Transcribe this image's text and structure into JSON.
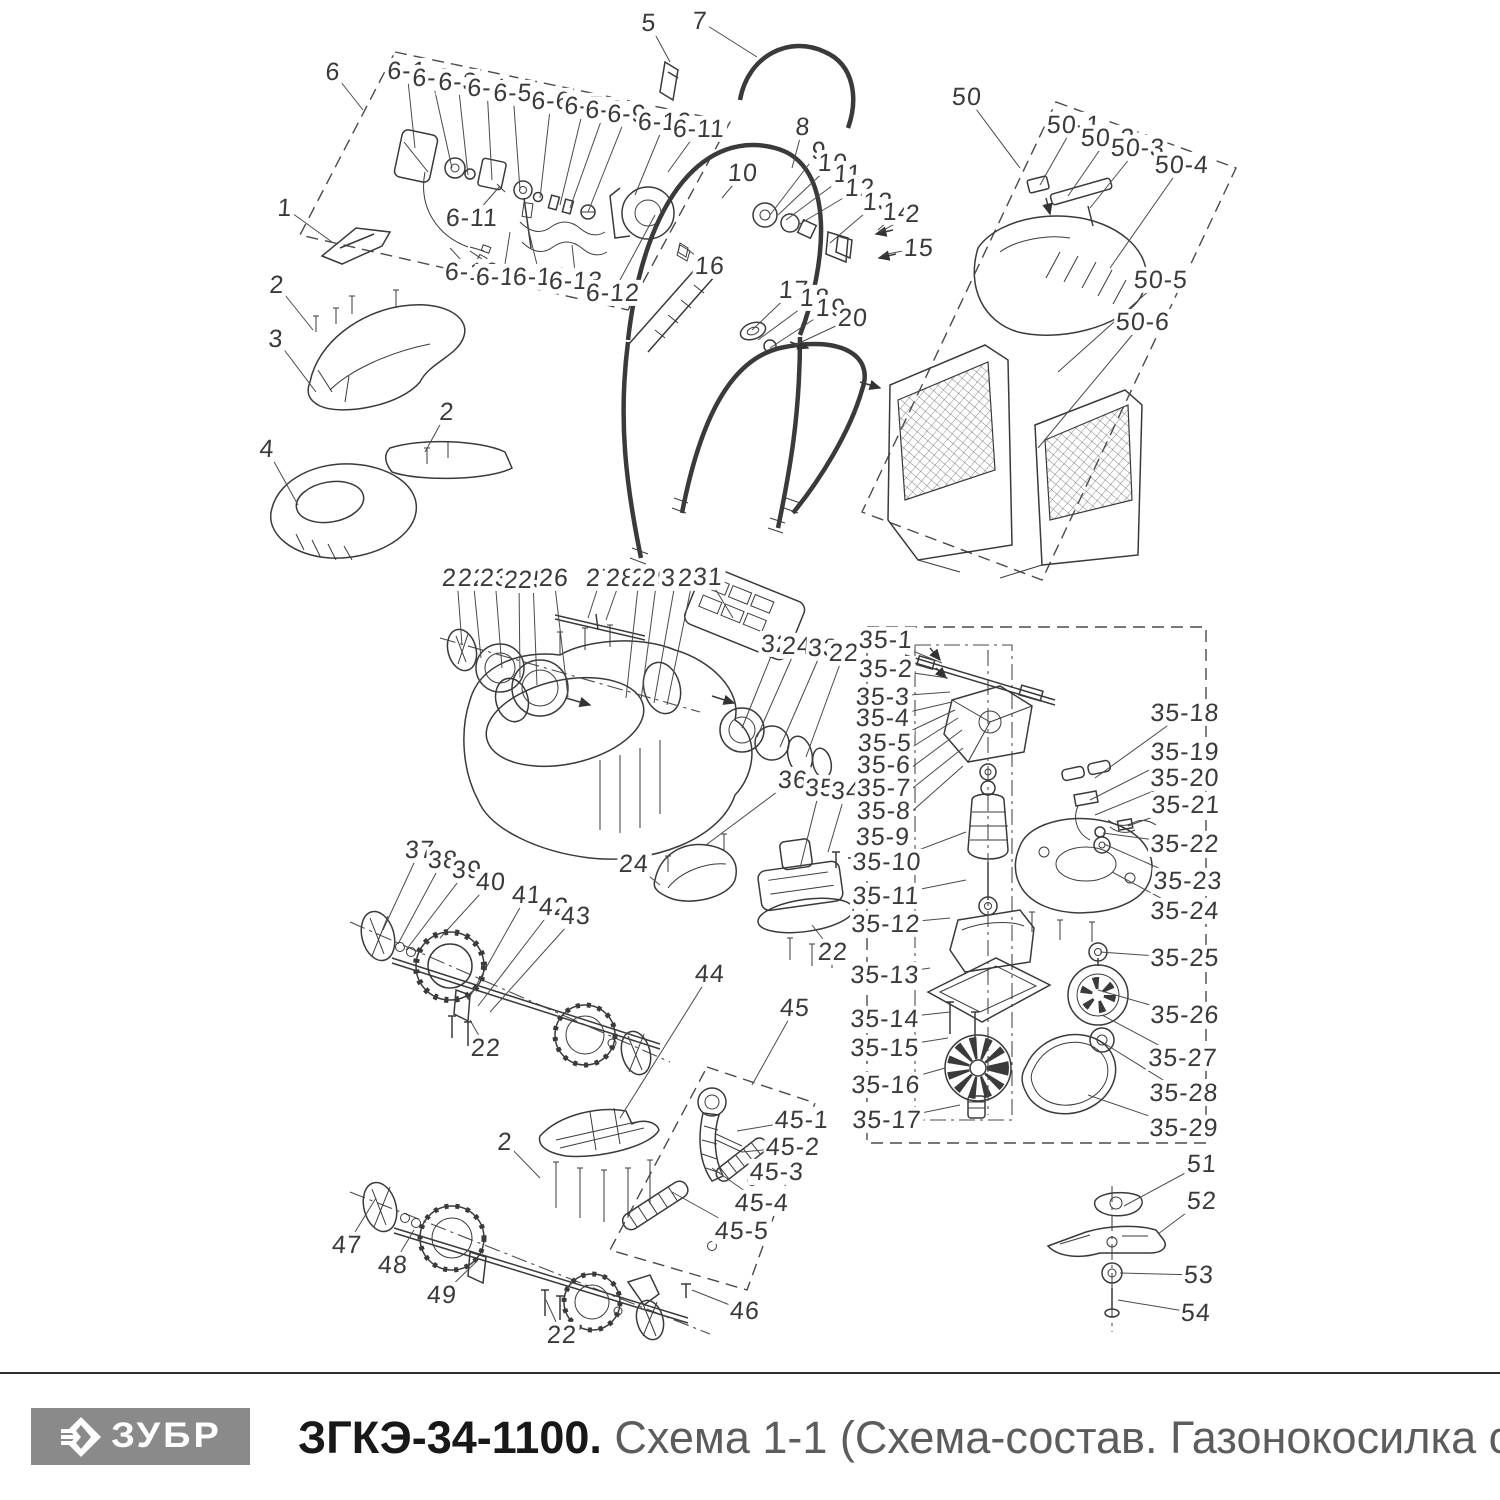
{
  "footer": {
    "brand": "ЗУБР",
    "title_bold": "ЗГКЭ-34-1100.",
    "title_rest": " Схема 1-1 (Схема-состав. Газонокосилка сетевая)"
  },
  "colors": {
    "line": "#3a3a3a",
    "label": "#3a3a3a",
    "logo_bg": "#8a8a8a",
    "logo_fg": "#ffffff",
    "title_black": "#181818",
    "title_gray": "#5c5c5c"
  },
  "labels": [
    {
      "t": "6",
      "x": 333,
      "y": 72,
      "lx": 363,
      "ly": 110
    },
    {
      "t": "6-1",
      "x": 407,
      "y": 71,
      "lx": 415,
      "ly": 148
    },
    {
      "t": "6-2",
      "x": 432,
      "y": 78,
      "lx": 452,
      "ly": 168
    },
    {
      "t": "6-3",
      "x": 458,
      "y": 82,
      "lx": 468,
      "ly": 175
    },
    {
      "t": "6-4",
      "x": 487,
      "y": 88,
      "lx": 492,
      "ly": 180
    },
    {
      "t": "6-5",
      "x": 513,
      "y": 93,
      "lx": 520,
      "ly": 190
    },
    {
      "t": "6-6",
      "x": 551,
      "y": 101,
      "lx": 540,
      "ly": 198
    },
    {
      "t": "6-7",
      "x": 584,
      "y": 106,
      "lx": 560,
      "ly": 205
    },
    {
      "t": "6-8",
      "x": 605,
      "y": 110,
      "lx": 570,
      "ly": 208
    },
    {
      "t": "6-9",
      "x": 627,
      "y": 114,
      "lx": 588,
      "ly": 212
    },
    {
      "t": "6-10",
      "x": 665,
      "y": 122,
      "lx": 635,
      "ly": 195
    },
    {
      "t": "6-11",
      "x": 699,
      "y": 129,
      "lx": 668,
      "ly": 172
    },
    {
      "t": "6-11",
      "x": 472,
      "y": 218,
      "lx": 500,
      "ly": 186
    },
    {
      "t": "6-16",
      "x": 472,
      "y": 272,
      "lx": 450,
      "ly": 248
    },
    {
      "t": "6-15",
      "x": 503,
      "y": 277,
      "lx": 510,
      "ly": 232
    },
    {
      "t": "6-14",
      "x": 540,
      "y": 277,
      "lx": 528,
      "ly": 228
    },
    {
      "t": "6-13",
      "x": 576,
      "y": 281,
      "lx": 572,
      "ly": 245
    },
    {
      "t": "6-12",
      "x": 613,
      "y": 293,
      "lx": 655,
      "ly": 215
    },
    {
      "t": "16",
      "x": 710,
      "y": 266,
      "lx": 688,
      "ly": 250
    },
    {
      "t": "5",
      "x": 649,
      "y": 23,
      "lx": 670,
      "ly": 62
    },
    {
      "t": "7",
      "x": 700,
      "y": 21,
      "lx": 757,
      "ly": 57
    },
    {
      "t": "8",
      "x": 803,
      "y": 127,
      "lx": 792,
      "ly": 168
    },
    {
      "t": "9",
      "x": 819,
      "y": 151,
      "lx": 770,
      "ly": 215
    },
    {
      "t": "10",
      "x": 833,
      "y": 163,
      "lx": 778,
      "ly": 215
    },
    {
      "t": "10",
      "x": 743,
      "y": 173,
      "lx": 722,
      "ly": 198
    },
    {
      "t": "11",
      "x": 848,
      "y": 174,
      "lx": 786,
      "ly": 220
    },
    {
      "t": "12",
      "x": 860,
      "y": 188,
      "lx": 798,
      "ly": 225
    },
    {
      "t": "13",
      "x": 878,
      "y": 202,
      "lx": 830,
      "ly": 243
    },
    {
      "t": "14",
      "x": 898,
      "y": 212,
      "lx": 878,
      "ly": 230
    },
    {
      "t": "2",
      "x": 913,
      "y": 214,
      "lx": 880,
      "ly": 232
    },
    {
      "t": "15",
      "x": 919,
      "y": 248,
      "lx": 882,
      "ly": 255
    },
    {
      "t": "17",
      "x": 794,
      "y": 290,
      "lx": 752,
      "ly": 330
    },
    {
      "t": "18",
      "x": 815,
      "y": 298,
      "lx": 758,
      "ly": 340
    },
    {
      "t": "19",
      "x": 831,
      "y": 308,
      "lx": 770,
      "ly": 348
    },
    {
      "t": "20",
      "x": 853,
      "y": 318,
      "lx": 795,
      "ly": 345
    },
    {
      "t": "50",
      "x": 967,
      "y": 97,
      "lx": 1020,
      "ly": 168
    },
    {
      "t": "50-1",
      "x": 1074,
      "y": 125,
      "lx": 1040,
      "ly": 185
    },
    {
      "t": "50-2",
      "x": 1108,
      "y": 138,
      "lx": 1068,
      "ly": 196
    },
    {
      "t": "50-3",
      "x": 1138,
      "y": 148,
      "lx": 1090,
      "ly": 208
    },
    {
      "t": "50-4",
      "x": 1182,
      "y": 165,
      "lx": 1110,
      "ly": 268
    },
    {
      "t": "50-5",
      "x": 1161,
      "y": 280,
      "lx": 1058,
      "ly": 372
    },
    {
      "t": "50-6",
      "x": 1143,
      "y": 322,
      "lx": 1038,
      "ly": 448
    },
    {
      "t": "1",
      "x": 285,
      "y": 208,
      "lx": 332,
      "ly": 242
    },
    {
      "t": "2",
      "x": 277,
      "y": 285,
      "lx": 313,
      "ly": 330
    },
    {
      "t": "3",
      "x": 276,
      "y": 339,
      "lx": 316,
      "ly": 392
    },
    {
      "t": "2",
      "x": 447,
      "y": 412,
      "lx": 425,
      "ly": 452
    },
    {
      "t": "4",
      "x": 267,
      "y": 449,
      "lx": 298,
      "ly": 505
    },
    {
      "t": "21",
      "x": 457,
      "y": 578,
      "lx": 462,
      "ly": 645
    },
    {
      "t": "22",
      "x": 473,
      "y": 578,
      "lx": 481,
      "ly": 658
    },
    {
      "t": "23",
      "x": 495,
      "y": 578,
      "lx": 502,
      "ly": 668
    },
    {
      "t": "24",
      "x": 519,
      "y": 580,
      "lx": 520,
      "ly": 678
    },
    {
      "t": "25",
      "x": 533,
      "y": 580,
      "lx": 537,
      "ly": 685
    },
    {
      "t": "26",
      "x": 554,
      "y": 578,
      "lx": 568,
      "ly": 697
    },
    {
      "t": "27",
      "x": 601,
      "y": 578,
      "lx": 588,
      "ly": 618
    },
    {
      "t": "28",
      "x": 621,
      "y": 578,
      "lx": 606,
      "ly": 620
    },
    {
      "t": "2",
      "x": 639,
      "y": 578,
      "lx": 626,
      "ly": 698
    },
    {
      "t": "29",
      "x": 657,
      "y": 578,
      "lx": 641,
      "ly": 700
    },
    {
      "t": "30",
      "x": 676,
      "y": 578,
      "lx": 654,
      "ly": 703
    },
    {
      "t": "24",
      "x": 693,
      "y": 578,
      "lx": 667,
      "ly": 705
    },
    {
      "t": "31",
      "x": 708,
      "y": 577,
      "lx": 733,
      "ly": 618
    },
    {
      "t": "32",
      "x": 776,
      "y": 644,
      "lx": 742,
      "ly": 728
    },
    {
      "t": "24",
      "x": 797,
      "y": 646,
      "lx": 757,
      "ly": 737
    },
    {
      "t": "33",
      "x": 823,
      "y": 648,
      "lx": 780,
      "ly": 747
    },
    {
      "t": "22",
      "x": 844,
      "y": 653,
      "lx": 806,
      "ly": 757
    },
    {
      "t": "36",
      "x": 793,
      "y": 780,
      "lx": 706,
      "ly": 845
    },
    {
      "t": "35",
      "x": 820,
      "y": 788,
      "lx": 800,
      "ly": 868
    },
    {
      "t": "34",
      "x": 846,
      "y": 791,
      "lx": 828,
      "ly": 852
    },
    {
      "t": "24",
      "x": 634,
      "y": 864,
      "lx": 660,
      "ly": 885
    },
    {
      "t": "22",
      "x": 833,
      "y": 952,
      "lx": 812,
      "ly": 925
    },
    {
      "t": "35-1",
      "x": 886,
      "y": 640,
      "lx": 942,
      "ly": 663
    },
    {
      "t": "35-2",
      "x": 886,
      "y": 669,
      "lx": 948,
      "ly": 678
    },
    {
      "t": "35-3",
      "x": 883,
      "y": 697,
      "lx": 950,
      "ly": 692
    },
    {
      "t": "35-4",
      "x": 883,
      "y": 718,
      "lx": 952,
      "ly": 702
    },
    {
      "t": "35-5",
      "x": 885,
      "y": 743,
      "lx": 955,
      "ly": 710
    },
    {
      "t": "35-6",
      "x": 884,
      "y": 765,
      "lx": 958,
      "ly": 718
    },
    {
      "t": "35-7",
      "x": 884,
      "y": 788,
      "lx": 962,
      "ly": 730
    },
    {
      "t": "35-8",
      "x": 884,
      "y": 811,
      "lx": 963,
      "ly": 748
    },
    {
      "t": "35-9",
      "x": 883,
      "y": 837,
      "lx": 963,
      "ly": 766
    },
    {
      "t": "35-10",
      "x": 887,
      "y": 862,
      "lx": 966,
      "ly": 832
    },
    {
      "t": "35-11",
      "x": 886,
      "y": 896,
      "lx": 966,
      "ly": 880
    },
    {
      "t": "35-12",
      "x": 886,
      "y": 924,
      "lx": 950,
      "ly": 918
    },
    {
      "t": "35-13",
      "x": 885,
      "y": 975,
      "lx": 930,
      "ly": 968
    },
    {
      "t": "35-14",
      "x": 885,
      "y": 1019,
      "lx": 950,
      "ly": 1012
    },
    {
      "t": "35-15",
      "x": 885,
      "y": 1048,
      "lx": 948,
      "ly": 1038
    },
    {
      "t": "35-16",
      "x": 886,
      "y": 1085,
      "lx": 945,
      "ly": 1068
    },
    {
      "t": "35-17",
      "x": 887,
      "y": 1120,
      "lx": 960,
      "ly": 1105
    },
    {
      "t": "35-18",
      "x": 1185,
      "y": 713,
      "lx": 1095,
      "ly": 778
    },
    {
      "t": "35-19",
      "x": 1185,
      "y": 752,
      "lx": 1090,
      "ly": 800
    },
    {
      "t": "35-20",
      "x": 1185,
      "y": 778,
      "lx": 1095,
      "ly": 815
    },
    {
      "t": "35-21",
      "x": 1186,
      "y": 805,
      "lx": 1128,
      "ly": 826
    },
    {
      "t": "35-22",
      "x": 1185,
      "y": 844,
      "lx": 1103,
      "ly": 833
    },
    {
      "t": "35-23",
      "x": 1188,
      "y": 881,
      "lx": 1104,
      "ly": 844
    },
    {
      "t": "35-24",
      "x": 1185,
      "y": 911,
      "lx": 1112,
      "ly": 872
    },
    {
      "t": "35-25",
      "x": 1185,
      "y": 958,
      "lx": 1100,
      "ly": 952
    },
    {
      "t": "35-26",
      "x": 1185,
      "y": 1015,
      "lx": 1098,
      "ly": 990
    },
    {
      "t": "35-27",
      "x": 1183,
      "y": 1058,
      "lx": 1102,
      "ly": 1015
    },
    {
      "t": "35-28",
      "x": 1184,
      "y": 1093,
      "lx": 1102,
      "ly": 1042
    },
    {
      "t": "35-29",
      "x": 1184,
      "y": 1128,
      "lx": 1088,
      "ly": 1095
    },
    {
      "t": "37",
      "x": 420,
      "y": 850,
      "lx": 383,
      "ly": 930
    },
    {
      "t": "38",
      "x": 443,
      "y": 860,
      "lx": 398,
      "ly": 944
    },
    {
      "t": "39",
      "x": 467,
      "y": 870,
      "lx": 406,
      "ly": 950
    },
    {
      "t": "40",
      "x": 491,
      "y": 882,
      "lx": 440,
      "ly": 938
    },
    {
      "t": "41",
      "x": 527,
      "y": 895,
      "lx": 468,
      "ly": 1000
    },
    {
      "t": "42",
      "x": 554,
      "y": 907,
      "lx": 478,
      "ly": 1006
    },
    {
      "t": "43",
      "x": 576,
      "y": 916,
      "lx": 490,
      "ly": 1012
    },
    {
      "t": "22",
      "x": 486,
      "y": 1048,
      "lx": 470,
      "ly": 1020
    },
    {
      "t": "44",
      "x": 710,
      "y": 974,
      "lx": 620,
      "ly": 1118
    },
    {
      "t": "45",
      "x": 795,
      "y": 1008,
      "lx": 752,
      "ly": 1085
    },
    {
      "t": "2",
      "x": 505,
      "y": 1142,
      "lx": 540,
      "ly": 1178
    },
    {
      "t": "45-1",
      "x": 802,
      "y": 1120,
      "lx": 737,
      "ly": 1131
    },
    {
      "t": "45-2",
      "x": 793,
      "y": 1147,
      "lx": 742,
      "ly": 1152
    },
    {
      "t": "45-3",
      "x": 777,
      "y": 1172,
      "lx": 752,
      "ly": 1180
    },
    {
      "t": "45-4",
      "x": 762,
      "y": 1203,
      "lx": 712,
      "ly": 1168
    },
    {
      "t": "45-5",
      "x": 742,
      "y": 1231,
      "lx": 672,
      "ly": 1192
    },
    {
      "t": "46",
      "x": 745,
      "y": 1311,
      "lx": 692,
      "ly": 1290
    },
    {
      "t": "47",
      "x": 347,
      "y": 1245,
      "lx": 376,
      "ly": 1198
    },
    {
      "t": "48",
      "x": 393,
      "y": 1265,
      "lx": 414,
      "ly": 1230
    },
    {
      "t": "49",
      "x": 442,
      "y": 1295,
      "lx": 476,
      "ly": 1262
    },
    {
      "t": "22",
      "x": 562,
      "y": 1335,
      "lx": 546,
      "ly": 1300
    },
    {
      "t": "51",
      "x": 1202,
      "y": 1164,
      "lx": 1124,
      "ly": 1206
    },
    {
      "t": "52",
      "x": 1202,
      "y": 1201,
      "lx": 1158,
      "ly": 1234
    },
    {
      "t": "53",
      "x": 1199,
      "y": 1275,
      "lx": 1120,
      "ly": 1273
    },
    {
      "t": "54",
      "x": 1196,
      "y": 1313,
      "lx": 1118,
      "ly": 1300
    }
  ]
}
